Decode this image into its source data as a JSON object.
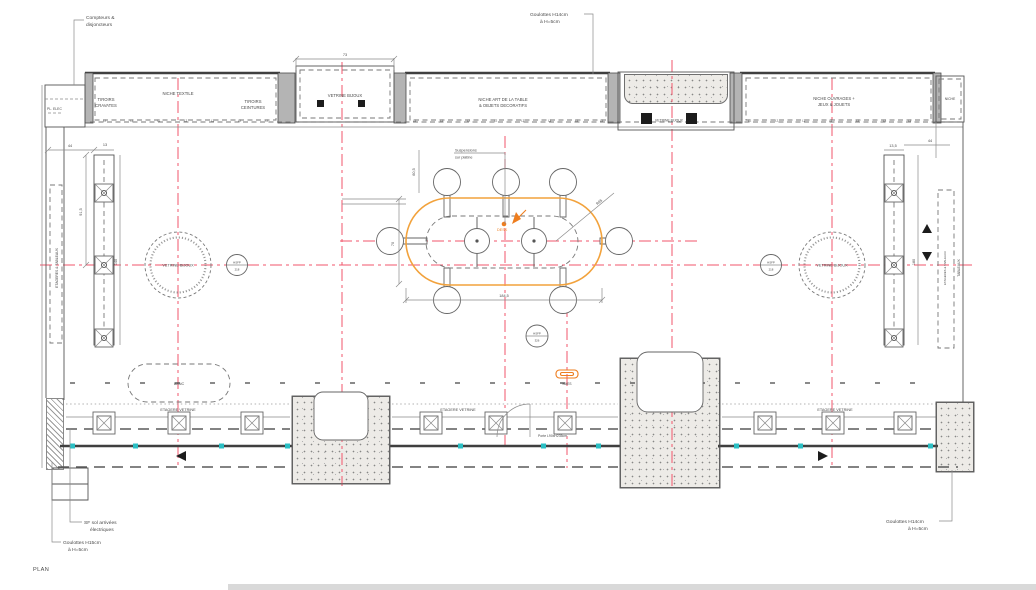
{
  "title": "PLAN",
  "colors": {
    "axis_red": "#f2566b",
    "accent_orange": "#ee7d1e",
    "desk_orange": "#f2a23c",
    "storefront_teal": "#2bbfc4",
    "line_gray": "#4a4a4a"
  },
  "annotations": {
    "compteurs": {
      "line1": "Compteurs &",
      "line2": "disjoncteurs"
    },
    "goulottes_top": {
      "line1": "Goulottes H14cm",
      "line2": "à H=5cm"
    },
    "suspensions": {
      "line1": "Suspensions",
      "line2": "sur platine"
    },
    "sf_sol": {
      "line1": "SF sol arrivées",
      "line2": "électriques"
    },
    "goulottes_bottom_left": {
      "line1": "Goulottes H15cm",
      "line2": "à H=5cm"
    },
    "goulottes_bottom_right": {
      "line1": "Goulottes H14cm",
      "line2": "à H=5cm"
    }
  },
  "niches": {
    "pl_elec": "PL. ELEC",
    "tiroirs_cravates": {
      "line1": "TIROIRS",
      "line2": "CRAVATES"
    },
    "niche_textile": "NICHE TEXTILE",
    "tiroirs_ceintures": {
      "line1": "TIROIRS",
      "line2": "CEINTURES"
    },
    "vetrine_bijoux_left": "VETRINE BIJOUX",
    "niche_art": {
      "line1": "NICHE ART DE LA TABLE",
      "line2": "& OBJETS DECORATIFS"
    },
    "vetrine_bijoux_center": "VETRINE BIJOUX",
    "niche_ouvrages": {
      "line1": "NICHE OUVRAGES +",
      "line2": "JEUX & JOUETS"
    },
    "niche_right": "NICHE"
  },
  "labels": {
    "vetrine_circle": "VETRINE BIJOUX",
    "hsfp": "HSFP",
    "hsfp_num_side": "218",
    "hsfp_num_center": "326",
    "desk": "DESK",
    "banc": "BANC",
    "baes": "BAES",
    "etagere_vetrine": "ETAGERE VETRINE",
    "porte": "Porte L90xH235cm",
    "etageres_tableaux": "ETAGERES & TABLEAUX",
    "tableaux": "TABLEAUX",
    "shelf_tick": "L2",
    "plan": "PLAN"
  },
  "dimensions": {
    "d73": "73",
    "d44": "44",
    "d13": "13",
    "d91_5": "91,5",
    "d140": "140",
    "d13_5": "13,5",
    "d44r": "44",
    "d180": "180",
    "d184_5": "184,5",
    "d70": "70",
    "d60_5": "60,5",
    "r95": "R95"
  }
}
